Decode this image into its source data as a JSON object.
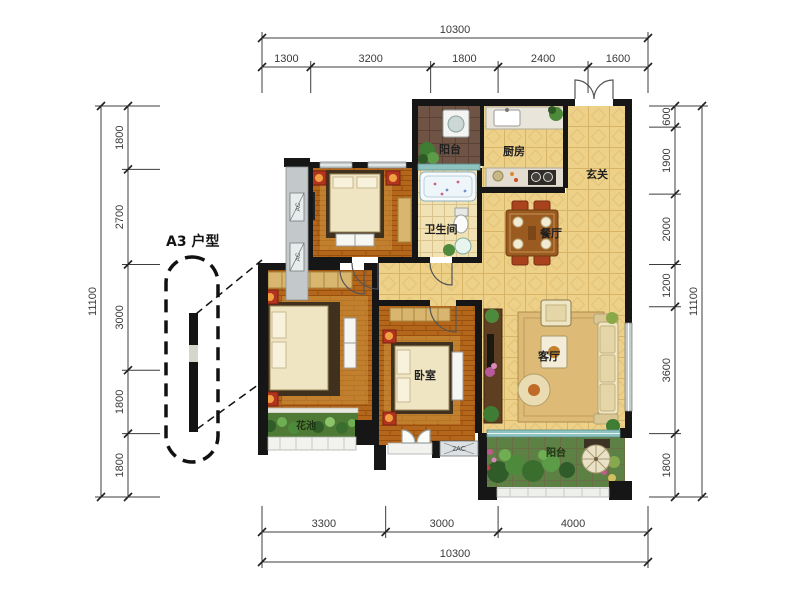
{
  "title": "A3 户型",
  "rooms": {
    "balcony_top": "阳台",
    "kitchen": "厨房",
    "entry": "玄关",
    "bathroom": "卫生间",
    "dining": "餐厅",
    "living": "客厅",
    "bedroom": "卧室",
    "flower_bed": "花池",
    "balcony_bottom": "阳台"
  },
  "equipment": {
    "ac_left_top": "AC",
    "ac_left_bottom": "AC",
    "ac_bottom": "2AC"
  },
  "dimensions": {
    "top": {
      "total": "10300",
      "segments": [
        "1300",
        "3200",
        "1800",
        "2400",
        "1600"
      ]
    },
    "bottom": {
      "total": "10300",
      "segments": [
        "3300",
        "3000",
        "4000"
      ]
    },
    "left": {
      "total": "11100",
      "segments": [
        "1800",
        "2700",
        "3000",
        "1800",
        "1800"
      ]
    },
    "right": {
      "total": "11100",
      "segments": [
        "600",
        "1900",
        "2000",
        "1200",
        "3600",
        "1800"
      ]
    }
  },
  "colors": {
    "wall": "#161616",
    "tile_floor": "#eed189",
    "wood_floor": "#b4661b",
    "balcony_dark_tile": "#6f5446",
    "garden_green": "#5d8044",
    "accent_red": "#b23420",
    "window_gray": "#c6cbcb",
    "window_teal": "#8fc3bf",
    "dimension_line": "#3c3c3c"
  }
}
